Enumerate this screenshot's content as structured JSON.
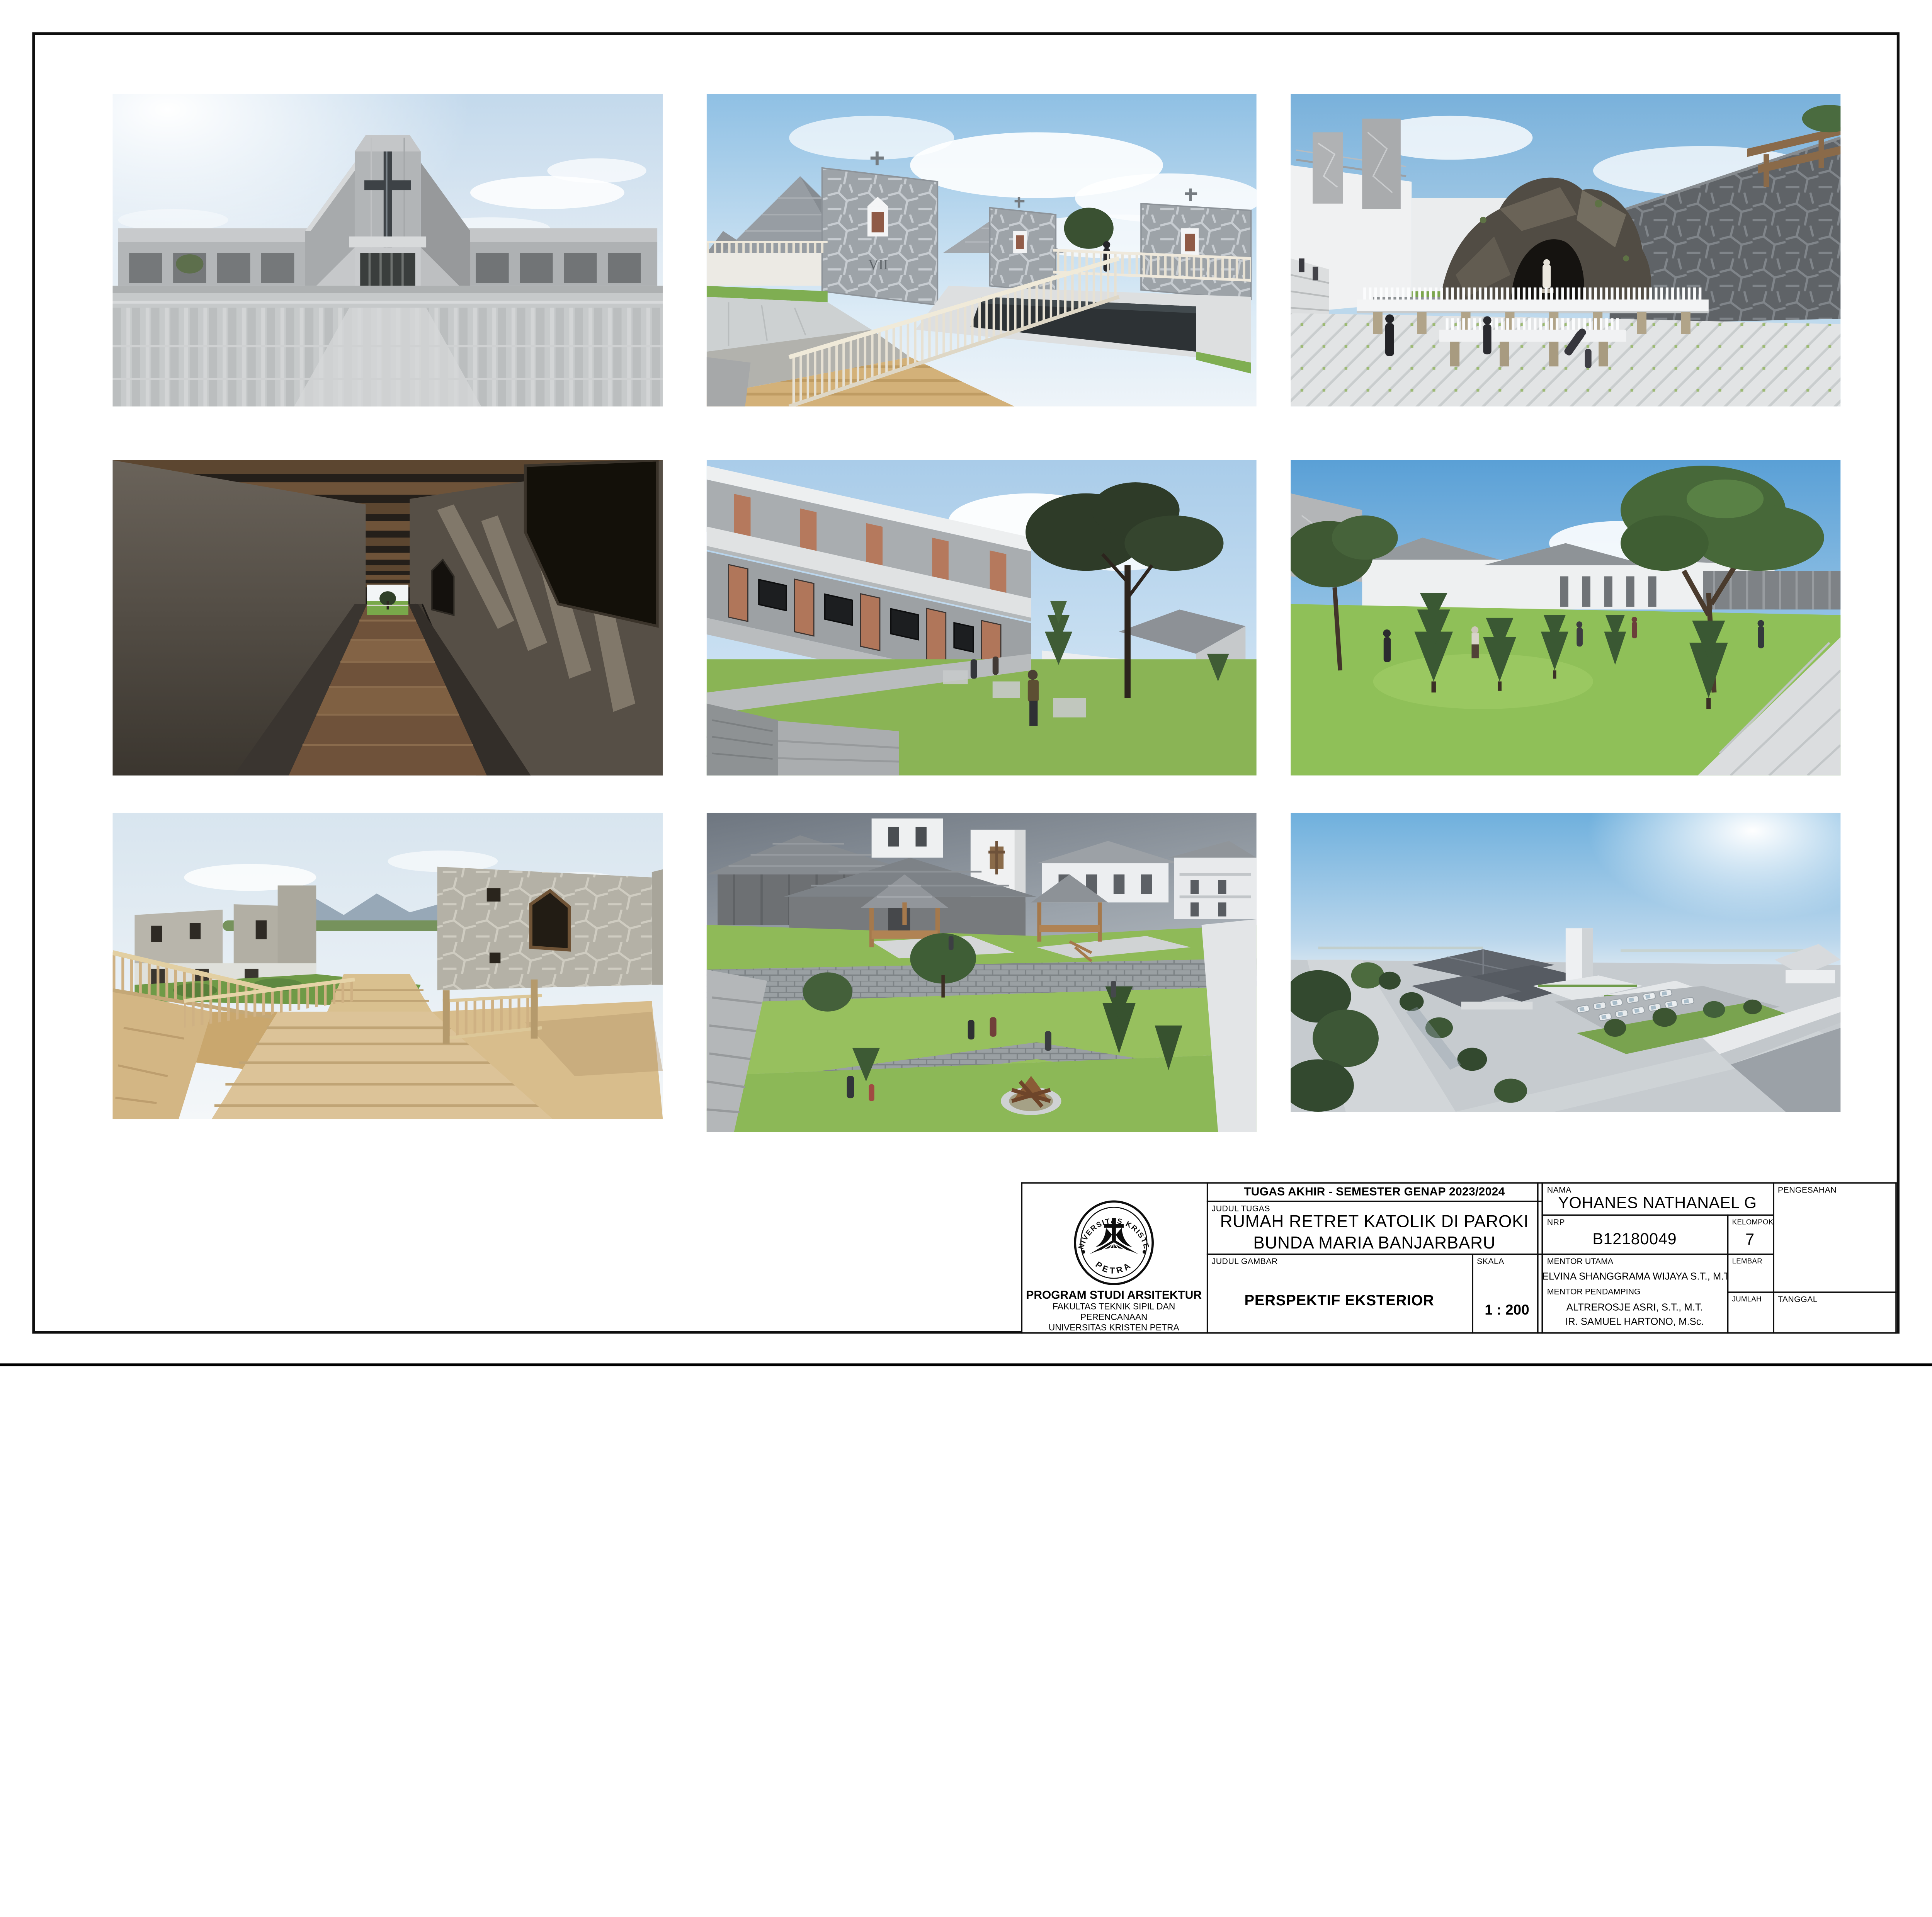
{
  "title_block": {
    "header": "TUGAS AKHIR - SEMESTER GENAP 2023/2024",
    "judul_tugas_label": "JUDUL TUGAS",
    "judul_tugas_line1": "RUMAH RETRET KATOLIK DI PAROKI",
    "judul_tugas_line2": "BUNDA MARIA BANJARBARU",
    "judul_gambar_label": "JUDUL GAMBAR",
    "judul_gambar": "PERSPEKTIF EKSTERIOR",
    "skala_label": "SKALA",
    "skala": "1 : 200",
    "nama_label": "NAMA",
    "nama": "YOHANES NATHANAEL G",
    "nrp_label": "NRP",
    "nrp": "B12180049",
    "kelompok_label": "KELOMPOK",
    "kelompok": "7",
    "mentor_utama_label": "MENTOR UTAMA",
    "mentor_utama": "ELVINA SHANGGRAMA WIJAYA S.T., M.T.",
    "mentor_pendamping_label": "MENTOR PENDAMPING",
    "mentor_pendamping_1": "ALTREROSJE ASRI, S.T., M.T.",
    "mentor_pendamping_2": "IR. SAMUEL HARTONO, M.Sc.",
    "lembar_label": "LEMBAR",
    "jumlah_label": "JUMLAH",
    "tanggal_label": "TANGGAL",
    "pengesahan_label": "PENGESAHAN",
    "institution": {
      "seal_top": "UNIVERSITAS KRISTEN",
      "seal_bottom": "PETRA",
      "line1": "PROGRAM STUDI ARSITEKTUR",
      "line2": "FAKULTAS TEKNIK SIPIL DAN PERENCANAAN",
      "line3": "UNIVERSITAS KRISTEN PETRA",
      "line4": "SURABAYA"
    }
  },
  "gallery": {
    "rows": 3,
    "cols": 3,
    "station_numeral": "VII",
    "items": [
      {
        "id": "church-facade",
        "description": "Symmetrical concrete church facade with tall cross-window tower, angled flanking walls, low colonnade wings and striped paver plaza under a pale sky"
      },
      {
        "id": "stations-courtyard",
        "description": "Roof court with flagstone station walls numbered VII, pyramid shingle roofs, cream picket railings, sunken dark pool and timber boardwalk"
      },
      {
        "id": "grotto-plaza",
        "description": "Herringbone paved plaza with dark rock Marian grotto, candle offering tables on stone piers, white building with stone panels and rising flagstone wall"
      },
      {
        "id": "timber-corridor",
        "description": "Dark cloister corridor with rough plaster walls, timber beam ceiling, plank walkway over gravel and bright green garden view at the end"
      },
      {
        "id": "dormitory-courtyard",
        "description": "Two storey concrete dormitory wing with terracotta doors and dark windows around a grass courtyard with a large tree and visitors"
      },
      {
        "id": "garden-lawn",
        "description": "Open lawn with young conifers and a large shade tree, white pavilions with grey hip roofs and a herringbone paver path under blue sky"
      },
      {
        "id": "deck-amphitheatre",
        "description": "Wide timber deck steps and balustrades descending between flagstone clad buildings toward a garden with mountains on the horizon"
      },
      {
        "id": "terraced-garden",
        "description": "Overcast view over terraced lawns with timber gazebos, gabion retaining walls, campfire circle, grey shingle roofs and white chapel tower"
      },
      {
        "id": "aerial-site",
        "description": "Hazy aerial view of the retreat complex with dark hip roofs, white chapel tower, tree lined road and rows of parked white cars"
      }
    ]
  },
  "palette": {
    "paper": "#ffffff",
    "line": "#0d0d0d",
    "sky_blue": "#7ab1db",
    "sky_pale": "#dce8f2",
    "concrete": "#aaadaf",
    "stone_dark": "#606468",
    "wood": "#d3b384",
    "grass": "#8aba55",
    "roof_grey": "#8d9298",
    "door_terracotta": "#b0765a",
    "pool_dark": "#2d3235"
  }
}
